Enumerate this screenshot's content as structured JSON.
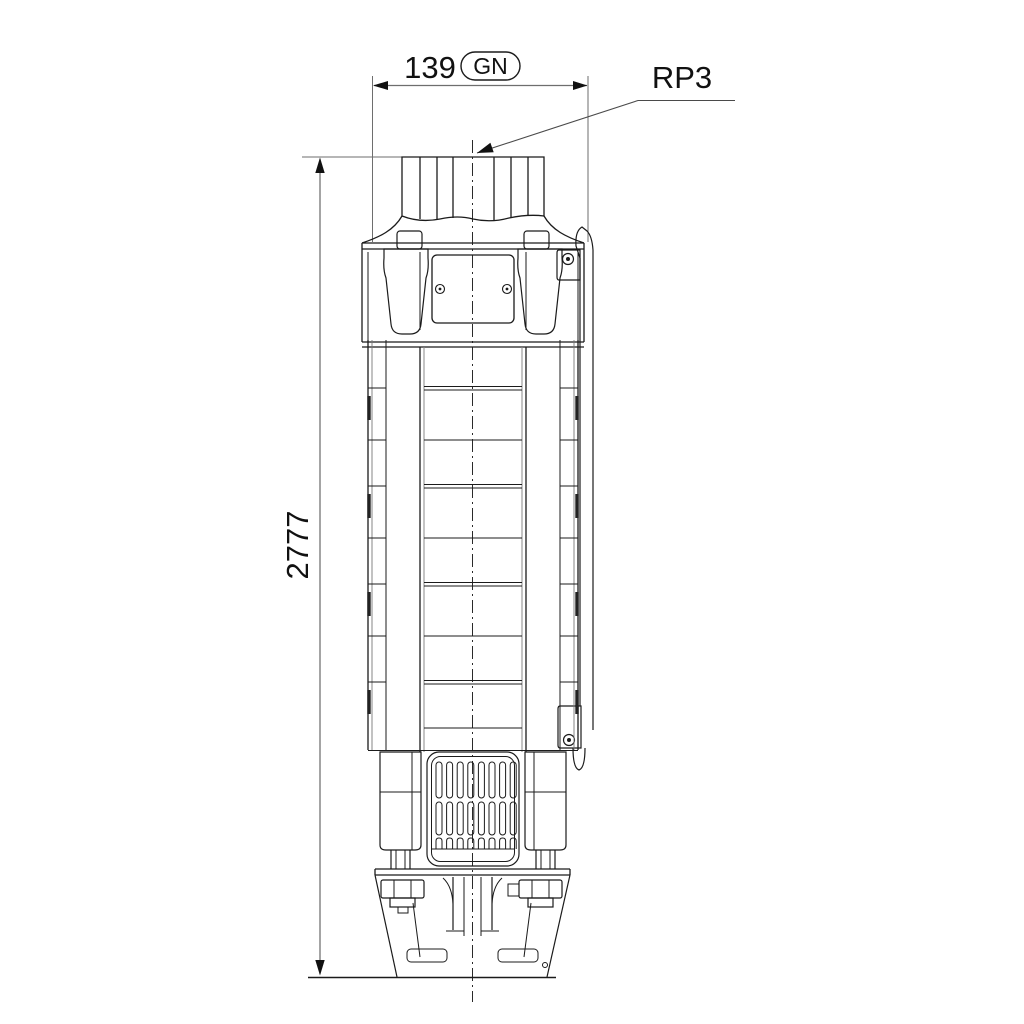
{
  "drawing": {
    "width_dim": {
      "value": "139",
      "badge": "GN"
    },
    "connection_label": "RP3",
    "length_dim": {
      "value": "2777"
    }
  },
  "colors": {
    "line": "#1b1b1b",
    "dim_line": "#6e6e6e",
    "background": "#ffffff"
  }
}
